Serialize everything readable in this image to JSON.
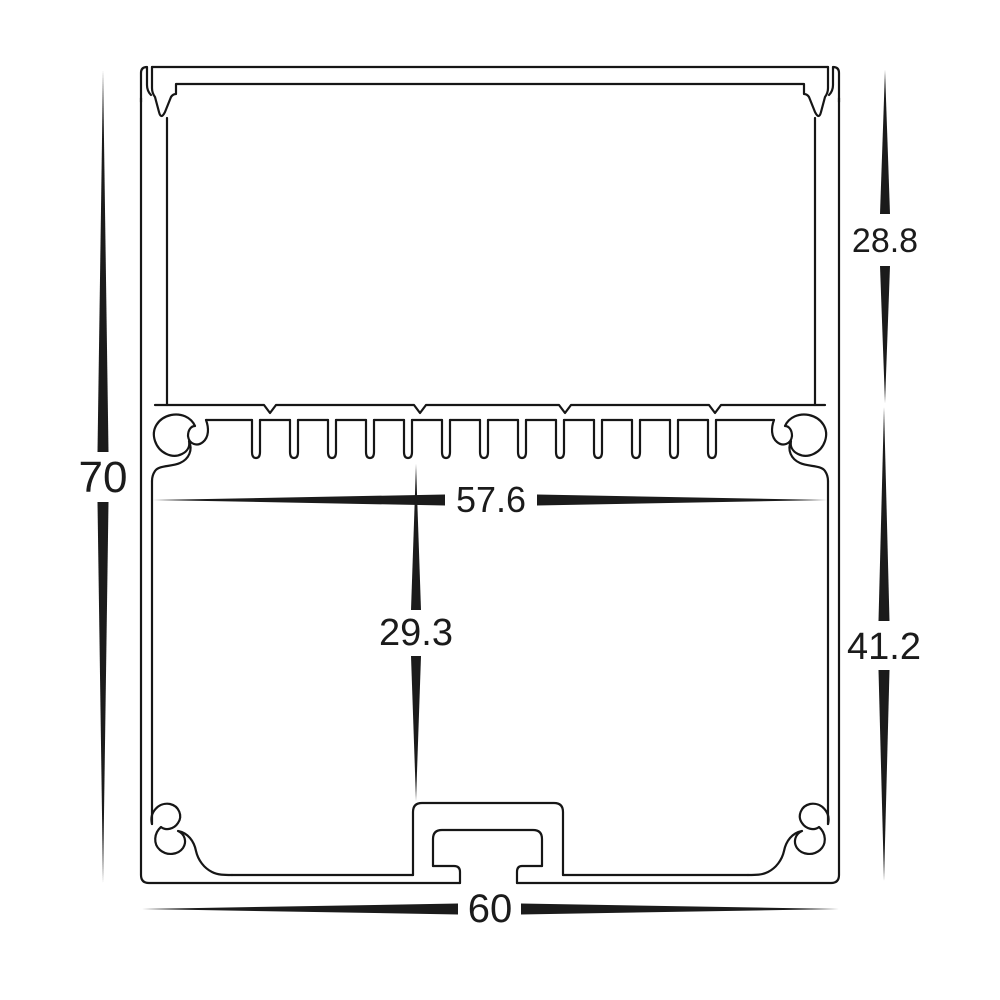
{
  "drawing": {
    "type": "technical-cross-section",
    "subject": "aluminium LED extrusion profile cross-section with heatsink fins, screw bosses and mounting channel",
    "background_color": "#ffffff",
    "line_color": "#161616",
    "dimensions": {
      "overall_height": "70",
      "top_section_height": "28.8",
      "bottom_section_height": "41.2",
      "inner_width": "57.6",
      "inner_cavity_height": "29.3",
      "overall_width": "60"
    }
  }
}
